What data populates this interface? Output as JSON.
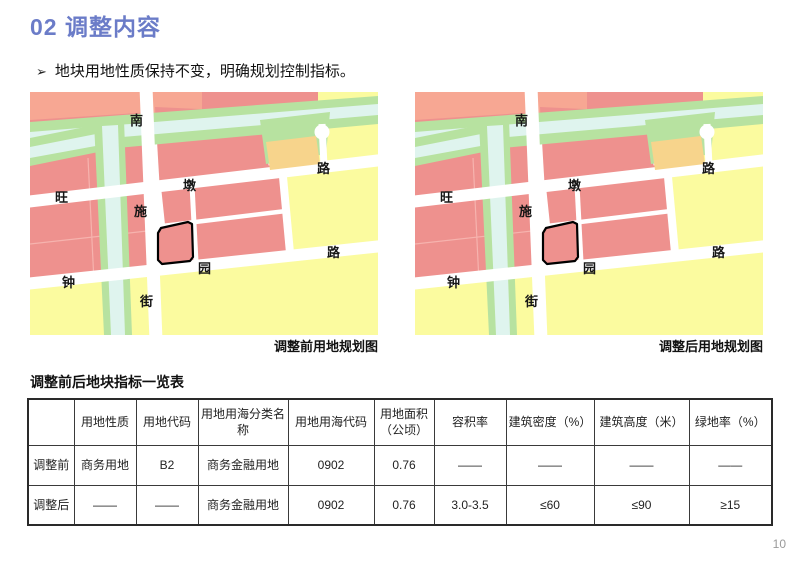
{
  "slide": {
    "title": "02 调整内容",
    "bullet_marker": "➢",
    "bullet_text": "地块用地性质保持不变，明确规划控制指标。",
    "page_number": "10",
    "accent_color": "#6B7CC8"
  },
  "maps": {
    "before_caption": "调整前用地规划图",
    "after_caption": "调整后用地规划图",
    "road_labels": {
      "nan": "南",
      "shi": "施",
      "jie": "街",
      "wang": "旺",
      "dun": "墩",
      "lu_top": "路",
      "zhong": "钟",
      "yuan": "园",
      "lu_bottom": "路"
    },
    "legend_colors": {
      "residential_pink": "#EE918E",
      "salmon_strip": "#F7A793",
      "development_yellow": "#FBFB9F",
      "green_space": "#B7E2A0",
      "water": "#DFF4EE",
      "mixed_orange": "#F7D48C"
    }
  },
  "table": {
    "title": "调整前后地块指标一览表",
    "headers": [
      "",
      "用地性质",
      "用地代码",
      "用地用海分类名称",
      "用地用海代码",
      "用地面积（公顷）",
      "容积率",
      "建筑密度（%）",
      "建筑高度（米）",
      "绿地率（%）"
    ],
    "rows": [
      {
        "label": "调整前",
        "cells": [
          "商务用地",
          "B2",
          "商务金融用地",
          "0902",
          "0.76",
          "——",
          "——",
          "——",
          "——"
        ]
      },
      {
        "label": "调整后",
        "cells": [
          "——",
          "——",
          "商务金融用地",
          "0902",
          "0.76",
          "3.0-3.5",
          "≤60",
          "≤90",
          "≥15"
        ]
      }
    ]
  }
}
